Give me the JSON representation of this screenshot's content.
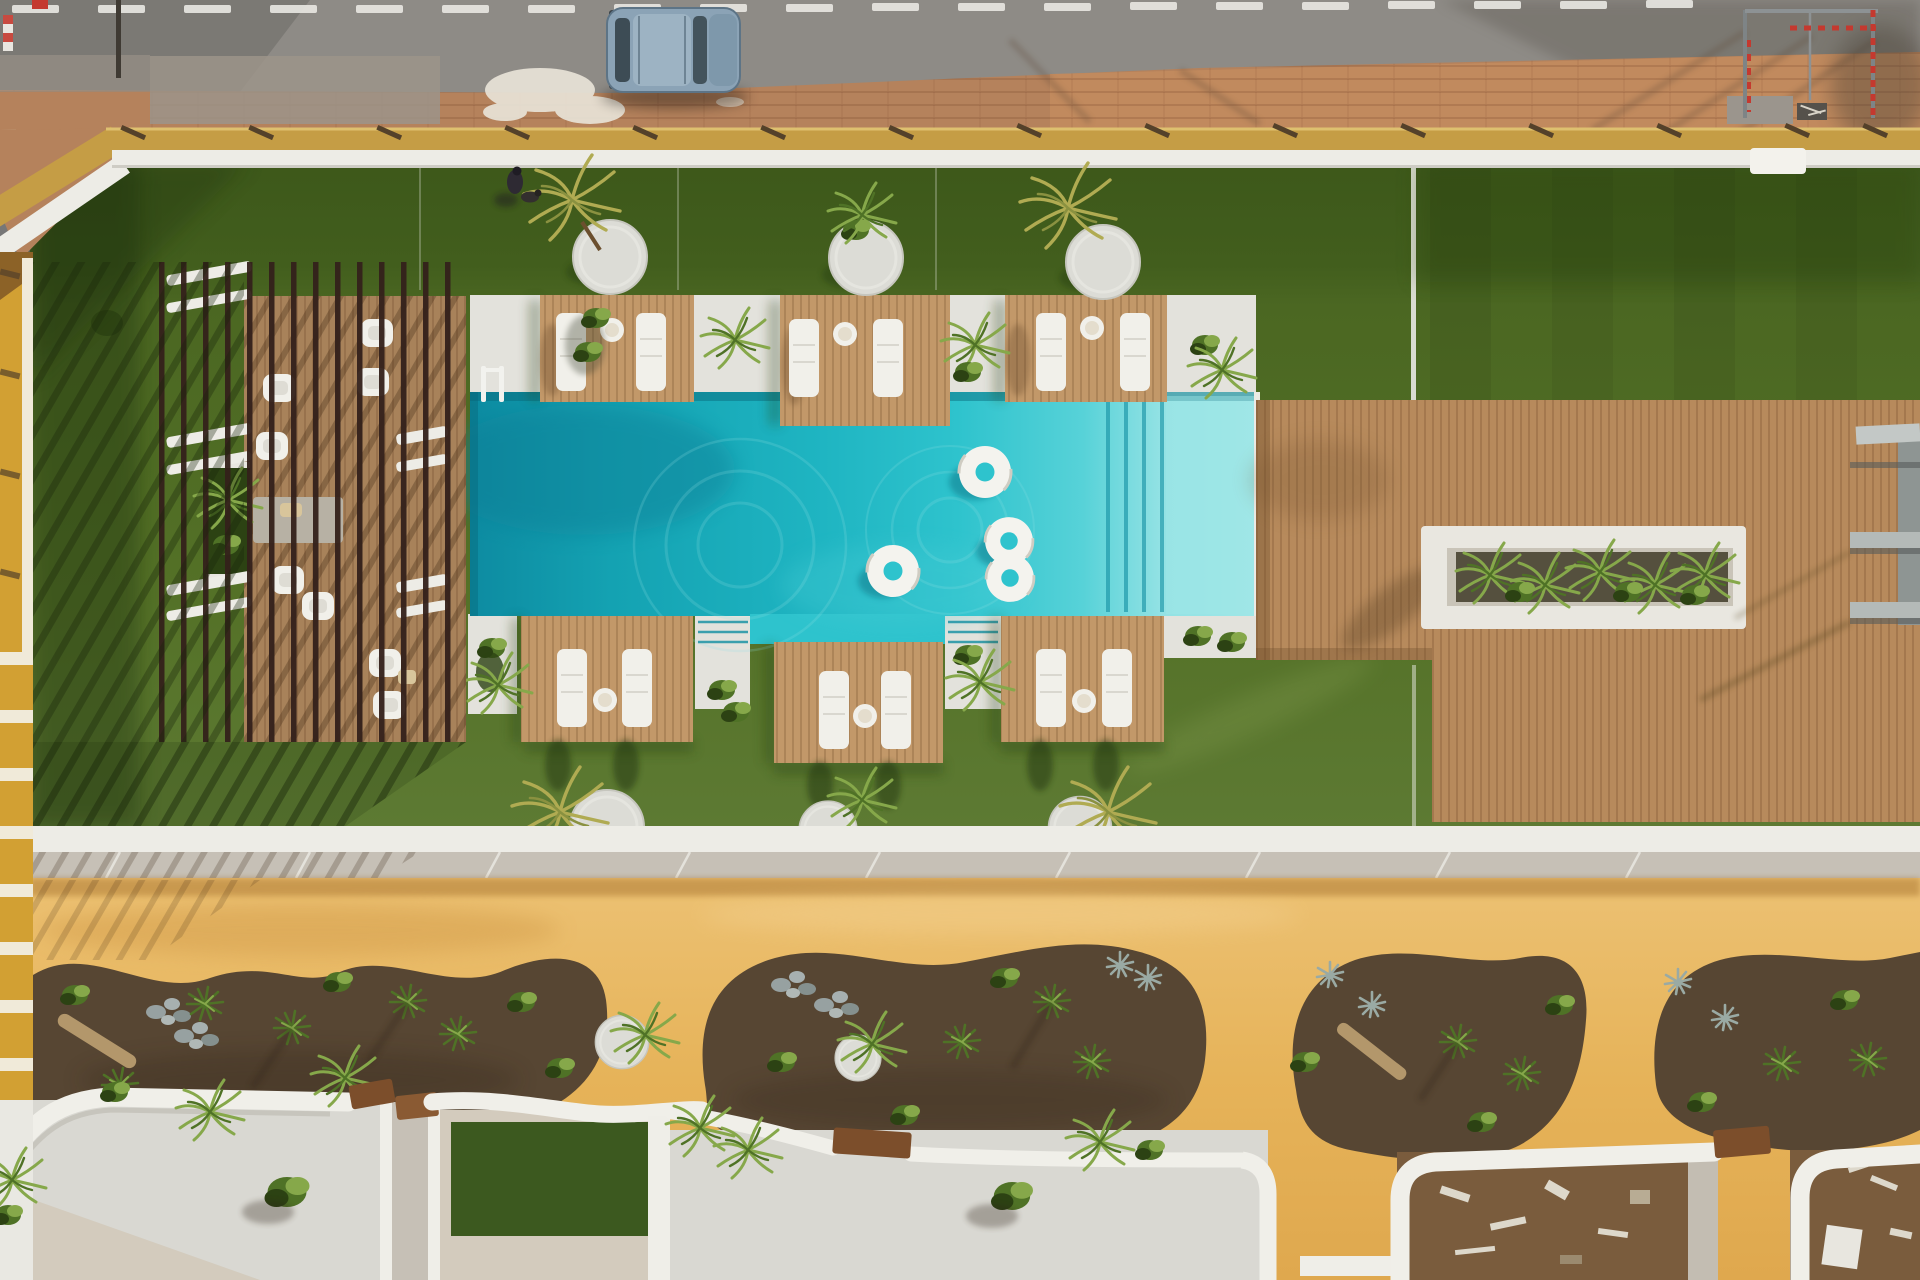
{
  "meta": {
    "type": "aerial-drone-photo",
    "subject": "Aerial top-down view of a resort courtyard: street with parked car, artificial lawn, slatted pergola lounge, turquoise pool with six wooden lounger platforms and swim rings, timber deck with planter, sandy promenade with landscaped beds, and five walled private terraces",
    "width": 1920,
    "height": 1280
  },
  "scene": {
    "road": {
      "lane_dashes": 20,
      "parked_cars": 1,
      "car_color": "blue-grey hatchback"
    },
    "sidewalk": {
      "material": "terracotta pavers",
      "goal_frames": 1,
      "striped_poles": 2
    },
    "lawn": {
      "palm_islands_top": 3,
      "palm_islands_bottom": 3,
      "people": 1,
      "dogs": 1
    },
    "pergola": {
      "slats": 14,
      "armchairs": 9,
      "rug": 1,
      "planter_strips": 1
    },
    "pool": {
      "swim_rings": 4,
      "ladders": 1,
      "step_flights": 1,
      "shallow_shelf": true
    },
    "sun_platforms": {
      "count": 6,
      "loungers_per_platform": 2,
      "side_tables": 6
    },
    "right_deck": {
      "planter_boxes": 1,
      "shade_shelf_structures": 1
    },
    "promenade": {
      "garden_beds": 4,
      "rock_clusters": 3,
      "driftwood_logs": 2
    },
    "terraces": {
      "count": 5,
      "gates": 3,
      "turf_patios": 1,
      "under_construction": 2
    }
  },
  "colors": {
    "road": "#8e8b86",
    "roadDash": "#e9e8e3",
    "carBody": "#8ba3b6",
    "carGlass": "#3d4c55",
    "carRoof": "#9db3c3",
    "carHood": "#7e98ab",
    "sidewalk": "#b5825c",
    "sidewalkRight": "#c18a5e",
    "sidewalkGray": "#9c948a",
    "paint": "#eae5da",
    "stone": "#cfc3a8",
    "fenceStrip": "#c59d45",
    "tick": "#54412a",
    "wallWhite": "#edece6",
    "lawnTop": "#3d581a",
    "lawnBottom": "#5d7a33",
    "lawnShadow": "#1c2e0c",
    "slat": "#34211b",
    "deckWood": "#a8825a",
    "platformWood": "#c29869",
    "furnWhite": "#f1f0ea",
    "furnLine": "#d9d7cf",
    "rug": "#b7b1a4",
    "cushion": "#d8c59b",
    "plantDark": "#2c4213",
    "plantMid": "#4f7226",
    "plantLight": "#86a84a",
    "palmYellow": "#b0ab52",
    "agaveGray": "#9aaaa4",
    "poolDeep": "#0d8ba1",
    "poolBright": "#2ec3cd",
    "poolPale": "#93e2e4",
    "stepLine": "#128fa2",
    "walkWhite": "#e3e2dc",
    "ringWhite": "#f4f3ee",
    "rightDeck": "#b78a5c",
    "planterWhite": "#e9e7e0",
    "planterSoil": "#55503e",
    "grayStruct": "#8e9593",
    "grayBar": "#b4bab8",
    "sandLight": "#ecc173",
    "sandDark": "#dfa84e",
    "sandShadow": "#a06b28",
    "soil": "#574633",
    "logTan": "#b3976b",
    "rockGray": "#97a1a1",
    "gravel": "#d9d8d2",
    "paveBeige": "#d3cbbd",
    "paveGray": "#c6c0b6",
    "terraceGrass": "#3c591f",
    "dirt": "#7a5c3d",
    "facade": "#d2a033",
    "facadeWhite": "#f0ead9",
    "gate": "#7c4e2b",
    "poleRed": "#c4392f"
  }
}
